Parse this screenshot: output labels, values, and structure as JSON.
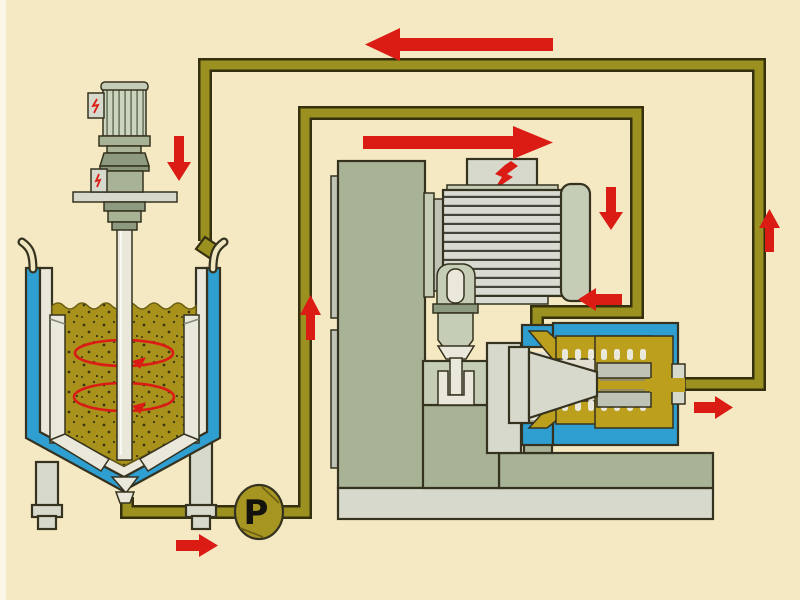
{
  "pump": {
    "label": "P"
  },
  "colors": {
    "bg": "#f5e9c4",
    "bg_edge": "#fbf6e7",
    "outline": "#35321f",
    "pipe_edge": "#35300e",
    "pipe_fill": "#9b9120",
    "red": "#da1c15",
    "blue": "#2f9fd2",
    "gold": "#bd9f1e",
    "content_gold": "#a8921c",
    "pump_gold": "#a79522",
    "sage": "#a8b295",
    "sage_light": "#c6cdb6",
    "sage_dark": "#8e9a80",
    "metal": "#d7d9cc",
    "metal_mid": "#bfc3b6",
    "white_part": "#eae8db",
    "cavity": "#e3e0d2"
  },
  "components": [
    "stirred-tank-with-cooling-jacket",
    "agitator-motor",
    "agitator-shaft",
    "flow-guide-tubes",
    "drain-funnel",
    "circulation-pump",
    "feed-pipeline",
    "return-pipeline",
    "mill-stand",
    "mill-drive-motor",
    "power-box-lightning",
    "shaft-coupling",
    "mill-chamber",
    "mill-rotor-cone",
    "toothed-stator",
    "outlet-flange"
  ],
  "flow_arrows": [
    {
      "id": "return-top",
      "direction": "left"
    },
    {
      "id": "feed-upper",
      "direction": "right"
    },
    {
      "id": "agitator-feed",
      "direction": "down"
    },
    {
      "id": "riser-after-pump",
      "direction": "up"
    },
    {
      "id": "mill-inlet-drop",
      "direction": "down"
    },
    {
      "id": "mill-inlet-turn",
      "direction": "left"
    },
    {
      "id": "mill-outlet",
      "direction": "right"
    },
    {
      "id": "return-riser",
      "direction": "up"
    },
    {
      "id": "pump-discharge",
      "direction": "right"
    }
  ]
}
